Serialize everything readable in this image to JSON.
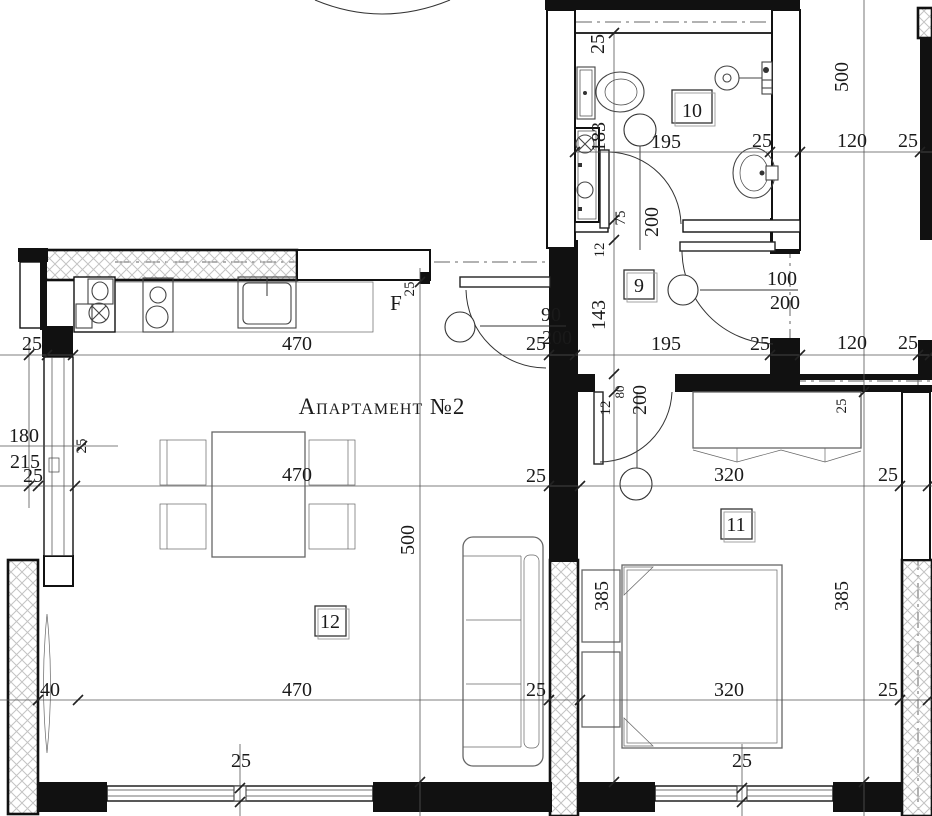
{
  "title": "Апартамент №2",
  "rooms": {
    "hall": "9",
    "bathroom": "10",
    "bedroom": "11",
    "living": "12"
  },
  "labels": {
    "fridge": "F"
  },
  "dims": {
    "d12": "12",
    "d25": "25",
    "d40": "40",
    "d75": "75",
    "d80": "80",
    "d90": "90",
    "d100": "100",
    "d120": "120",
    "d143": "143",
    "d180": "180",
    "d183": "183",
    "d195": "195",
    "d200": "200",
    "d215": "215",
    "d320": "320",
    "d385": "385",
    "d470": "470",
    "d500": "500"
  },
  "colors": {
    "wall": "#111111",
    "line": "#333333",
    "hatch": "#c3c3c3",
    "background": "#ffffff"
  }
}
